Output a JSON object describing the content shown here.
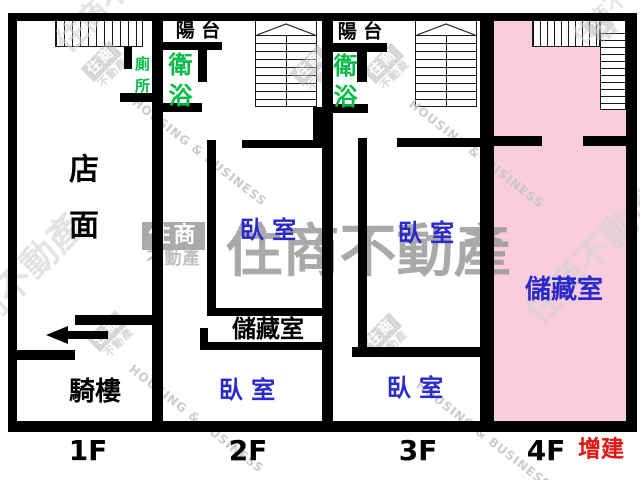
{
  "floors": {
    "f1": {
      "label": "1F",
      "toilet": "廁所",
      "storefront": "店面",
      "arcade": "騎樓"
    },
    "f2": {
      "label": "2F",
      "balcony": "陽 台",
      "bath": "衛浴",
      "bedroom_upper": "臥 室",
      "storage": "儲藏室",
      "bedroom_lower": "臥 室"
    },
    "f3": {
      "label": "3F",
      "balcony": "陽 台",
      "bath": "衛浴",
      "bedroom_upper": "臥 室",
      "bedroom_lower": "臥 室"
    },
    "f4": {
      "label": "4F",
      "storage": "儲藏室",
      "annotation": "增建"
    }
  },
  "watermark": {
    "brand": "住商不動產",
    "brand_box": "住商",
    "brand_sub": "不動產",
    "slogan": "HOUSING & BUSINESS"
  },
  "colors": {
    "wall_black": "#000000",
    "bedroom_blue": "#2929cc",
    "wet_area_green": "#00bb44",
    "annotation_red": "#e71210",
    "addition_pink": "#f9cdde",
    "watermark_gray": "#999999"
  }
}
